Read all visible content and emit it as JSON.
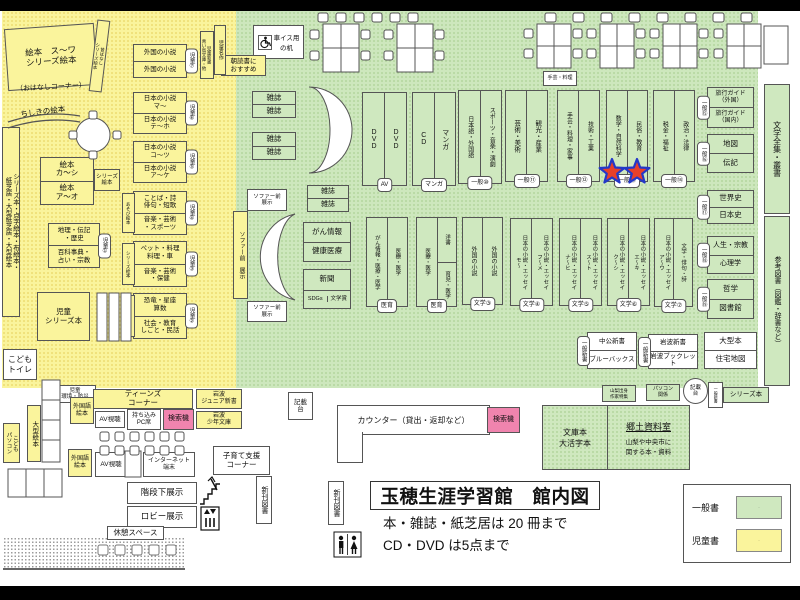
{
  "colors": {
    "generalGreen": "#CDE7BD",
    "childYellow": "#FAF49C",
    "searchPink": "#F084AE",
    "starRed": "#E8402A",
    "starBlue": "#2438C8"
  },
  "titleBlock": {
    "main": "玉穂生涯学習館　館内図",
    "line1": "本・雑誌・紙芝居は 20 冊まで",
    "line2": "CD・DVD は5点まで"
  },
  "legend": {
    "items": [
      {
        "label": "一般書",
        "color": "#CFE8BF"
      },
      {
        "label": "児童書",
        "color": "#FAF49C"
      }
    ]
  },
  "counter": {
    "label": "カウンター（貸出・返却など）"
  },
  "kyodo": {
    "left": "文庫本\n大活字本",
    "title": "郷土資料室",
    "desc": "山梨や中央市に\n関する本・資料"
  },
  "wheelchairDesk": {
    "label": "車イス用\nの机"
  },
  "boxes": [
    {
      "name": "ohanashi-corner",
      "kind": "plain",
      "x": 6,
      "y": 26,
      "w": 90,
      "h": 62,
      "fill": "y",
      "fs": 8.5,
      "rot": -4,
      "label": "絵本　ス～ワ\nシリーズ絵本"
    },
    {
      "name": "ohanashi-corner-note",
      "kind": "plain",
      "x": 6,
      "y": 82,
      "w": 90,
      "h": 13,
      "bare": true,
      "fs": 7,
      "rot": -3,
      "label": "（おはなしコーナー）"
    },
    {
      "name": "mukashi-series-ehon",
      "kind": "vtext",
      "x": 93,
      "y": 20,
      "w": 13,
      "h": 72,
      "fill": "y",
      "fs": 4.5,
      "rot": 7,
      "label": "昔ばなし\nシリーズ絵本"
    },
    {
      "name": "chishiki-ehon",
      "kind": "plain",
      "x": 12,
      "y": 106,
      "w": 62,
      "h": 13,
      "bare": true,
      "fs": 7.5,
      "rot": -7,
      "label": "ちしきの絵本"
    },
    {
      "name": "shelf-foreign-novels-child",
      "kind": "rows",
      "x": 133,
      "y": 44,
      "w": 54,
      "h": 34,
      "fill": "y",
      "fs": 6.5,
      "cells": [
        "外国の小説",
        "外国の小説"
      ],
      "tab": {
        "t": "児童⑦",
        "pos": "r"
      }
    },
    {
      "name": "shelf-jp-novels-ma",
      "kind": "rows",
      "x": 133,
      "y": 92,
      "w": 54,
      "h": 42,
      "fill": "y",
      "fs": 6.5,
      "cells": [
        "日本の小説\nマ～",
        "日本の小説\nテ～ホ"
      ],
      "tab": {
        "t": "児童⑥",
        "pos": "r"
      }
    },
    {
      "name": "shelf-jp-novels-ko",
      "kind": "rows",
      "x": 133,
      "y": 141,
      "w": 54,
      "h": 42,
      "fill": "y",
      "fs": 6.5,
      "cells": [
        "日本の小説\nコ～ツ",
        "日本の小説\nア～ケ"
      ],
      "tab": {
        "t": "児童⑤",
        "pos": "r"
      }
    },
    {
      "name": "shelf-kotoba",
      "kind": "rows",
      "x": 133,
      "y": 191,
      "w": 54,
      "h": 44,
      "fill": "y",
      "fs": 6.5,
      "cells": [
        "ことば・詩\n俳句・短歌",
        "音楽・芸術\n・スポーツ"
      ],
      "tab": {
        "t": "児童④",
        "pos": "r"
      },
      "side": {
        "t": "あそび絵本"
      }
    },
    {
      "name": "shelf-pet",
      "kind": "rows",
      "x": 133,
      "y": 241,
      "w": 54,
      "h": 46,
      "fill": "y",
      "fs": 6.5,
      "cells": [
        "ペット・料理\n料理・車",
        "音楽・芸術\n・保健"
      ],
      "tab": {
        "t": "児童③",
        "pos": "r"
      },
      "side": {
        "t": "シリーズ絵本"
      }
    },
    {
      "name": "shelf-kyoryu",
      "kind": "rows",
      "x": 133,
      "y": 293,
      "w": 54,
      "h": 46,
      "fill": "y",
      "fs": 6.5,
      "cells": [
        "恐竜・星座\n算数",
        "社会・教育\nしごと・民話"
      ],
      "tab": {
        "t": "児童②",
        "pos": "r"
      },
      "side": {
        "t": "児童大型本"
      }
    },
    {
      "name": "shelf-chiri",
      "kind": "rows",
      "x": 48,
      "y": 223,
      "w": 52,
      "h": 45,
      "fill": "y",
      "fs": 6.5,
      "cells": [
        "地理・伝記\n・歴史",
        "百科事典・\n占い・宗教"
      ],
      "tab": {
        "t": "児童①",
        "pos": "r"
      }
    },
    {
      "name": "shelf-ehon-ka",
      "kind": "rows",
      "x": 40,
      "y": 157,
      "w": 54,
      "h": 48,
      "fill": "y",
      "fs": 7.5,
      "cells": [
        "絵本\nカ～シ",
        "絵本\nア～オ"
      ]
    },
    {
      "name": "series-ehon-small",
      "kind": "plain",
      "x": 94,
      "y": 169,
      "w": 26,
      "h": 22,
      "fill": "y",
      "fs": 5.5,
      "label": "シリーズ\n絵本"
    },
    {
      "name": "shelf-series-tenji",
      "kind": "vtext",
      "x": 2,
      "y": 127,
      "w": 18,
      "h": 190,
      "fill": "y",
      "fs": 6.5,
      "label": "シリーズ本・点字絵本・布絵本・\n紙芝居・大型紙芝居・大型絵本"
    },
    {
      "name": "jidou-series-bon",
      "kind": "plain",
      "x": 37,
      "y": 292,
      "w": 53,
      "h": 49,
      "fill": "y",
      "fs": 7.5,
      "label": "児童\nシリーズ本"
    },
    {
      "name": "kodomo-toilet",
      "kind": "plain",
      "x": 3,
      "y": 349,
      "w": 34,
      "h": 31,
      "fill": "w",
      "fs": 8,
      "label": "こども\nトイレ"
    },
    {
      "name": "jidou-kankyo-bosai",
      "kind": "plain",
      "x": 54,
      "y": 385,
      "w": 42,
      "h": 18,
      "fill": "w",
      "fs": 5.5,
      "label": "児童\n環境・防災"
    },
    {
      "name": "ogata-ehon",
      "kind": "vtext",
      "x": 27,
      "y": 405,
      "w": 14,
      "h": 57,
      "fill": "y",
      "fs": 6.5,
      "label": "大型絵本"
    },
    {
      "name": "kodomo-pc",
      "kind": "vtext",
      "x": 3,
      "y": 423,
      "w": 17,
      "h": 40,
      "fill": "y",
      "fs": 5.5,
      "label": "こども\nパソコン"
    },
    {
      "name": "teens-corner",
      "kind": "plain",
      "x": 93,
      "y": 389,
      "w": 100,
      "h": 20,
      "fill": "y",
      "fs": 7.5,
      "label": "ティーンズ\nコーナー"
    },
    {
      "name": "gaikokugo-ehon-1",
      "kind": "plain",
      "x": 70,
      "y": 397,
      "w": 24,
      "h": 27,
      "fill": "y",
      "fs": 6,
      "label": "外国語\n絵本"
    },
    {
      "name": "av-shicho-1",
      "kind": "plain",
      "x": 95,
      "y": 411,
      "w": 30,
      "h": 17,
      "fill": "w",
      "fs": 6.5,
      "label": "AV視聴"
    },
    {
      "name": "mochikomi-pc-seat",
      "kind": "plain",
      "x": 127,
      "y": 409,
      "w": 34,
      "h": 21,
      "fill": "w",
      "fs": 6,
      "label": "持ち込み\nPC席"
    },
    {
      "name": "kensakuki-1",
      "kind": "plain",
      "x": 163,
      "y": 409,
      "w": 31,
      "h": 21,
      "fill": "p",
      "fs": 7,
      "label": "検索機"
    },
    {
      "name": "iwanami-junior",
      "kind": "plain",
      "x": 196,
      "y": 389,
      "w": 46,
      "h": 20,
      "fill": "y",
      "fs": 6,
      "label": "岩波\nジュニア新書"
    },
    {
      "name": "iwanami-shonen",
      "kind": "plain",
      "x": 196,
      "y": 411,
      "w": 46,
      "h": 18,
      "fill": "y",
      "fs": 6,
      "label": "岩波\n少年文庫"
    },
    {
      "name": "gaikokugo-ehon-2",
      "kind": "plain",
      "x": 68,
      "y": 449,
      "w": 24,
      "h": 28,
      "fill": "y",
      "fs": 6,
      "label": "外国語\n絵本"
    },
    {
      "name": "av-shicho-2",
      "kind": "plain",
      "x": 95,
      "y": 452,
      "w": 32,
      "h": 25,
      "fill": "w",
      "fs": 6.5,
      "label": "AV視聴"
    },
    {
      "name": "internet-tanmatsu",
      "kind": "plain",
      "x": 143,
      "y": 452,
      "w": 52,
      "h": 25,
      "fill": "w",
      "fs": 6,
      "label": "インターネット\n端末"
    },
    {
      "name": "kosodate-corner",
      "kind": "plain",
      "x": 213,
      "y": 446,
      "w": 57,
      "h": 29,
      "fill": "w",
      "fs": 7.5,
      "label": "子育て支援\nコーナー"
    },
    {
      "name": "kaidan-shita-tenji",
      "kind": "plain",
      "x": 127,
      "y": 482,
      "w": 70,
      "h": 22,
      "fill": "w",
      "fs": 8.5,
      "label": "階段下展示"
    },
    {
      "name": "lobby-tenji",
      "kind": "plain",
      "x": 127,
      "y": 506,
      "w": 70,
      "h": 22,
      "fill": "w",
      "fs": 8.5,
      "label": "ロビー展示"
    },
    {
      "name": "kyukei-space",
      "kind": "plain",
      "x": 107,
      "y": 526,
      "w": 57,
      "h": 14,
      "fill": "w",
      "fs": 7.5,
      "label": "休憩スペース"
    },
    {
      "name": "shinkan-tosho-1",
      "kind": "vtext",
      "x": 256,
      "y": 476,
      "w": 16,
      "h": 48,
      "fill": "w",
      "fs": 7,
      "label": "新刊図書"
    },
    {
      "name": "shinkan-tosho-2",
      "kind": "vtext",
      "x": 328,
      "y": 481,
      "w": 16,
      "h": 44,
      "fill": "w",
      "fs": 7,
      "label": "新刊図書"
    },
    {
      "name": "asadoku-osusume",
      "kind": "plain",
      "x": 221,
      "y": 55,
      "w": 45,
      "h": 21,
      "fill": "y",
      "fs": 6.5,
      "label": "朝読書に\nおすすめ"
    },
    {
      "name": "jidou-meisaku",
      "kind": "vtext",
      "x": 214,
      "y": 25,
      "w": 12,
      "h": 50,
      "fill": "y",
      "fs": 5,
      "label": "児童名作"
    },
    {
      "name": "jidou-shinsho",
      "kind": "vtext",
      "x": 200,
      "y": 31,
      "w": 14,
      "h": 48,
      "fill": "y",
      "fs": 4.5,
      "label": "児童新書\n青い鳥文庫・他"
    },
    {
      "name": "zasshi-rack-1",
      "kind": "rows",
      "x": 252,
      "y": 91,
      "w": 44,
      "h": 27,
      "fill": "g",
      "fs": 7.5,
      "cells": [
        "雑誌",
        "雑誌"
      ]
    },
    {
      "name": "zasshi-rack-2",
      "kind": "rows",
      "x": 252,
      "y": 132,
      "w": 44,
      "h": 28,
      "fill": "g",
      "fs": 7.5,
      "cells": [
        "雑誌",
        "雑誌"
      ]
    },
    {
      "name": "zasshi-rack-3",
      "kind": "rows",
      "x": 307,
      "y": 185,
      "w": 42,
      "h": 27,
      "fill": "g",
      "fs": 7,
      "cells": [
        "雑誌",
        "雑誌"
      ]
    },
    {
      "name": "sofa-mae-tenji-1",
      "kind": "plain",
      "x": 247,
      "y": 189,
      "w": 40,
      "h": 22,
      "fill": "w",
      "fs": 5.5,
      "label": "ソファー前\n展示"
    },
    {
      "name": "sofa-mae-tenji-strip",
      "kind": "vtext",
      "x": 233,
      "y": 211,
      "w": 15,
      "h": 88,
      "fill": "y",
      "fs": 6,
      "label": "ソファー前　展示"
    },
    {
      "name": "sofa-mae-tenji-2",
      "kind": "plain",
      "x": 247,
      "y": 301,
      "w": 40,
      "h": 21,
      "fill": "w",
      "fs": 5.5,
      "label": "ソファー前\n展示"
    },
    {
      "name": "gan-kenko",
      "kind": "rows",
      "x": 303,
      "y": 222,
      "w": 48,
      "h": 40,
      "fill": "g",
      "fs": 7.5,
      "cells": [
        "がん情報",
        "健康医療"
      ]
    },
    {
      "name": "shinbun-sdgs",
      "kind": "rows",
      "x": 303,
      "y": 269,
      "w": 48,
      "h": 40,
      "fill": "g",
      "fs": 7.5,
      "cells": [
        "新聞",
        {
          "cols": [
            "SDGs",
            "文学賞"
          ]
        }
      ]
    },
    {
      "name": "shelf-dvd",
      "kind": "cols",
      "x": 362,
      "y": 92,
      "w": 45,
      "h": 94,
      "fill": "g",
      "fs": 7,
      "cells": [
        "DVD",
        "DVD"
      ],
      "tab": {
        "t": "AV",
        "pos": "b"
      }
    },
    {
      "name": "shelf-cd-manga",
      "kind": "cols",
      "x": 412,
      "y": 92,
      "w": 44,
      "h": 94,
      "fill": "g",
      "fs": 7,
      "cells": [
        "CD",
        "マンガ"
      ],
      "tab": {
        "t": "マンガ",
        "pos": "b"
      }
    },
    {
      "name": "shelf-ippan-10",
      "kind": "cols",
      "x": 458,
      "y": 90,
      "w": 44,
      "h": 94,
      "fill": "g",
      "fs": 6,
      "cells": [
        "日本語・外国語",
        "スポーツ・音楽・演劇"
      ],
      "tab": {
        "t": "一般⑩",
        "pos": "b"
      }
    },
    {
      "name": "shelf-ippan-11",
      "kind": "cols",
      "x": 505,
      "y": 90,
      "w": 43,
      "h": 92,
      "fill": "g",
      "fs": 6.5,
      "cells": [
        "芸術・美術",
        "観光・産業"
      ],
      "tab": {
        "t": "一般⑪",
        "pos": "b"
      }
    },
    {
      "name": "shugei-ryori-mini",
      "kind": "plain",
      "x": 543,
      "y": 71,
      "w": 34,
      "h": 15,
      "fill": "w",
      "fs": 5,
      "label": "手芸・料理"
    },
    {
      "name": "shelf-ippan-12",
      "kind": "cols",
      "x": 557,
      "y": 90,
      "w": 43,
      "h": 92,
      "fill": "g",
      "fs": 6,
      "cells": [
        "手芸・料理・家事",
        "技術・工業"
      ],
      "tab": {
        "t": "一般⑫",
        "pos": "b"
      }
    },
    {
      "name": "shelf-ippan-13",
      "kind": "cols",
      "x": 606,
      "y": 90,
      "w": 42,
      "h": 92,
      "fill": "g",
      "fs": 6,
      "cells": [
        "数学・自然科学",
        "民俗・教育"
      ],
      "tab": {
        "t": "一般⑬",
        "pos": "b"
      }
    },
    {
      "name": "shelf-ippan-14",
      "kind": "cols",
      "x": 653,
      "y": 90,
      "w": 42,
      "h": 92,
      "fill": "g",
      "fs": 6,
      "cells": [
        "税金・福祉",
        "政治・法律"
      ],
      "tab": {
        "t": "一般⑭",
        "pos": "b"
      }
    },
    {
      "name": "shelf-travel-guide",
      "kind": "rows",
      "x": 707,
      "y": 87,
      "w": 47,
      "h": 41,
      "fill": "g",
      "fs": 6,
      "cells": [
        "旅行ガイド\n（外国）",
        "旅行ガイド\n（国内）"
      ],
      "tab": {
        "t": "一般⑮",
        "pos": "l"
      }
    },
    {
      "name": "shelf-chizu-denki",
      "kind": "rows",
      "x": 707,
      "y": 134,
      "w": 47,
      "h": 39,
      "fill": "g",
      "fs": 7.5,
      "cells": [
        "地図",
        "伝記"
      ],
      "tab": {
        "t": "一般⑯",
        "pos": "l"
      }
    },
    {
      "name": "shelf-sekaishi",
      "kind": "rows",
      "x": 707,
      "y": 190,
      "w": 47,
      "h": 34,
      "fill": "g",
      "fs": 7.5,
      "cells": [
        "世界史",
        "日本史"
      ],
      "tab": {
        "t": "一般⑰",
        "pos": "l"
      }
    },
    {
      "name": "shelf-jinsei",
      "kind": "rows",
      "x": 707,
      "y": 236,
      "w": 47,
      "h": 38,
      "fill": "g",
      "fs": 7,
      "cells": [
        "人生・宗教",
        "心理学"
      ],
      "tab": {
        "t": "一般⑱",
        "pos": "l"
      }
    },
    {
      "name": "shelf-tetsugaku",
      "kind": "rows",
      "x": 707,
      "y": 279,
      "w": 47,
      "h": 40,
      "fill": "g",
      "fs": 7.5,
      "cells": [
        "哲学",
        "図書館"
      ],
      "tab": {
        "t": "一般⑲",
        "pos": "l"
      }
    },
    {
      "name": "bungaku-zenshu",
      "kind": "vtext",
      "x": 764,
      "y": 84,
      "w": 26,
      "h": 130,
      "fill": "g",
      "fs": 8,
      "label": "文学全集・叢書"
    },
    {
      "name": "sanko-tosho",
      "kind": "vtext",
      "x": 764,
      "y": 216,
      "w": 26,
      "h": 170,
      "fill": "g",
      "fs": 7,
      "label": "参考図書（図鑑・辞書など）"
    },
    {
      "name": "shelf-iiku-1",
      "kind": "cols",
      "x": 366,
      "y": 217,
      "w": 42,
      "h": 90,
      "fill": "g",
      "fs": 5.5,
      "cells": [
        "がん情報・医療・医学",
        "医療・医学"
      ],
      "tab": {
        "t": "医育",
        "pos": "b"
      }
    },
    {
      "name": "shelf-iiku-2",
      "kind": "cols",
      "x": 416,
      "y": 217,
      "w": 41,
      "h": 90,
      "fill": "g",
      "fs": 5.5,
      "cells": [
        "医療・医学",
        {
          "rows": [
            "洋書",
            "育児・医学"
          ]
        }
      ],
      "tab": {
        "t": "医育",
        "pos": "b"
      }
    },
    {
      "name": "shelf-bungaku-3",
      "kind": "cols",
      "x": 462,
      "y": 217,
      "w": 41,
      "h": 88,
      "fill": "g",
      "fs": 6,
      "cells": [
        "外国の小説",
        "外国の小説"
      ],
      "tab": {
        "t": "文学③",
        "pos": "b"
      }
    },
    {
      "name": "shelf-bungaku-4",
      "kind": "cols",
      "x": 510,
      "y": 218,
      "w": 43,
      "h": 88,
      "fill": "g",
      "fs": 5.5,
      "cells": [
        "日本の小説・エッセイ\nモ～",
        "日本の小説・エッセイ\nフ～メ"
      ],
      "tab": {
        "t": "文学④",
        "pos": "b"
      }
    },
    {
      "name": "shelf-bungaku-5",
      "kind": "cols",
      "x": 559,
      "y": 218,
      "w": 43,
      "h": 88,
      "fill": "g",
      "fs": 5.5,
      "cells": [
        "日本の小説・エッセイ\nナ～ヒ",
        "日本の小説・エッセイ\nス～ト"
      ],
      "tab": {
        "t": "文学⑤",
        "pos": "b"
      }
    },
    {
      "name": "shelf-bungaku-6",
      "kind": "cols",
      "x": 607,
      "y": 218,
      "w": 43,
      "h": 88,
      "fill": "g",
      "fs": 5.5,
      "cells": [
        "日本の小説・エッセイ\nク～シ",
        "日本の小説・エッセイ\nエ～キ"
      ],
      "tab": {
        "t": "文学⑥",
        "pos": "b"
      }
    },
    {
      "name": "shelf-bungaku-7",
      "kind": "cols",
      "x": 654,
      "y": 218,
      "w": 39,
      "h": 89,
      "fill": "g",
      "fs": 5.5,
      "cells": [
        "日本の小説・エッセイ\nア～ウ",
        "文学・俳句・詩"
      ],
      "tab": {
        "t": "文学⑦",
        "pos": "b"
      }
    },
    {
      "name": "chuko-shinsho",
      "kind": "rows",
      "x": 587,
      "y": 332,
      "w": 50,
      "h": 37,
      "fill": "w",
      "fs": 6.5,
      "cells": [
        "中公新書",
        "ブルーバックス"
      ],
      "tab": {
        "t": "一般新書",
        "pos": "l"
      }
    },
    {
      "name": "iwanami-shinsho",
      "kind": "rows",
      "x": 648,
      "y": 334,
      "w": 50,
      "h": 35,
      "fill": "w",
      "fs": 6.5,
      "cells": [
        "岩波新書",
        "岩波ブックレット"
      ],
      "tab": {
        "t": "一般新書",
        "pos": "l"
      }
    },
    {
      "name": "ogata-bon-jutaku",
      "kind": "rows",
      "x": 704,
      "y": 332,
      "w": 53,
      "h": 37,
      "fill": "w",
      "fs": 7.5,
      "cells": [
        "大型本",
        "住宅地図"
      ]
    },
    {
      "name": "yamanashi-tokushu",
      "kind": "plain",
      "x": 602,
      "y": 385,
      "w": 34,
      "h": 17,
      "fill": "g",
      "fs": 4.5,
      "label": "山梨出身\n作家特集"
    },
    {
      "name": "pc-kankei",
      "kind": "plain",
      "x": 646,
      "y": 384,
      "w": 34,
      "h": 17,
      "fill": "g",
      "fs": 5,
      "label": "パソコン\n関係"
    },
    {
      "name": "kisaidai-circle",
      "kind": "plain",
      "x": 683,
      "y": 378,
      "w": 25,
      "h": 26,
      "fill": "w",
      "round": true,
      "fs": 5.5,
      "label": "記載\n台"
    },
    {
      "name": "ippan-shinsho-mini",
      "kind": "vtext",
      "x": 708,
      "y": 382,
      "w": 15,
      "h": 26,
      "fill": "w",
      "fs": 4,
      "label": "一般新書"
    },
    {
      "name": "series-bon-green",
      "kind": "plain",
      "x": 723,
      "y": 387,
      "w": 46,
      "h": 16,
      "fill": "g",
      "fs": 6.5,
      "label": "シリーズ本"
    },
    {
      "name": "kisaidai-left",
      "kind": "plain",
      "x": 288,
      "y": 392,
      "w": 25,
      "h": 28,
      "fill": "w",
      "fs": 6.5,
      "label": "記載\n台"
    },
    {
      "name": "kensakuki-2",
      "kind": "plain",
      "x": 487,
      "y": 407,
      "w": 33,
      "h": 26,
      "fill": "p",
      "fs": 7,
      "label": "検索機"
    }
  ]
}
